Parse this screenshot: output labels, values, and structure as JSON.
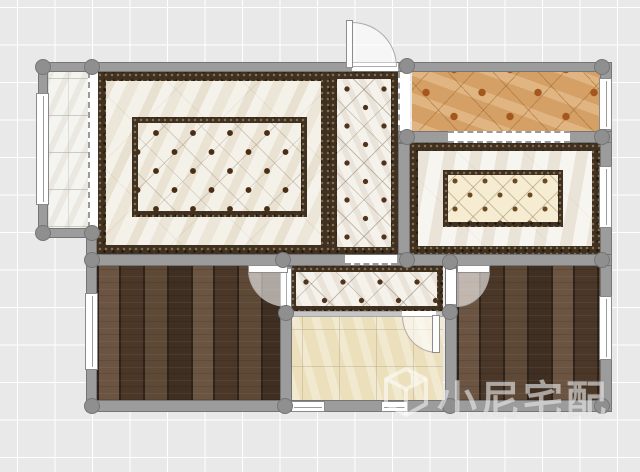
{
  "watermark": {
    "text": "小尼宅配",
    "icon": "cube-logo-icon"
  },
  "rooms": [
    {
      "id": "balcony-left",
      "floor": "white-tile"
    },
    {
      "id": "living-room",
      "floor": "marble-with-dark-border-and-dot-inlay"
    },
    {
      "id": "hallway",
      "floor": "white-diamond-tile-dark-border"
    },
    {
      "id": "balcony-top-right",
      "floor": "orange-diamond-tile"
    },
    {
      "id": "dining-room",
      "floor": "marble-with-cream-diamond-inlay"
    },
    {
      "id": "bedroom-left",
      "floor": "dark-wood-planks"
    },
    {
      "id": "corridor",
      "floor": "white-diamond-tile-dark-border"
    },
    {
      "id": "kitchen",
      "floor": "beige-tile"
    },
    {
      "id": "bedroom-right",
      "floor": "dark-wood-planks"
    }
  ],
  "colors": {
    "bg": "#e9e9e9",
    "grid": "#ffffff",
    "wall": "#9c9c9c",
    "walledge": "#757575",
    "post": "#8f8f8f",
    "dark": "#40301f",
    "marble": "#f0ebe0",
    "dot": "#4a2e14",
    "diamond": "#f5f2ec",
    "cream": "#f6ecd2",
    "orange": "#d4a066",
    "osq": "#a4571e",
    "wood1": "#6b5442",
    "wood2": "#4a3728",
    "wood3": "#5e4937",
    "wood4": "#3f2f22",
    "wgap": "#2e231a",
    "kitchen": "#ebdfbc",
    "btile": "#f4f4f0",
    "dfill": "rgba(255,255,255,0.58)",
    "dedge": "#ababab",
    "wm": "rgba(255,255,255,0.52)"
  }
}
